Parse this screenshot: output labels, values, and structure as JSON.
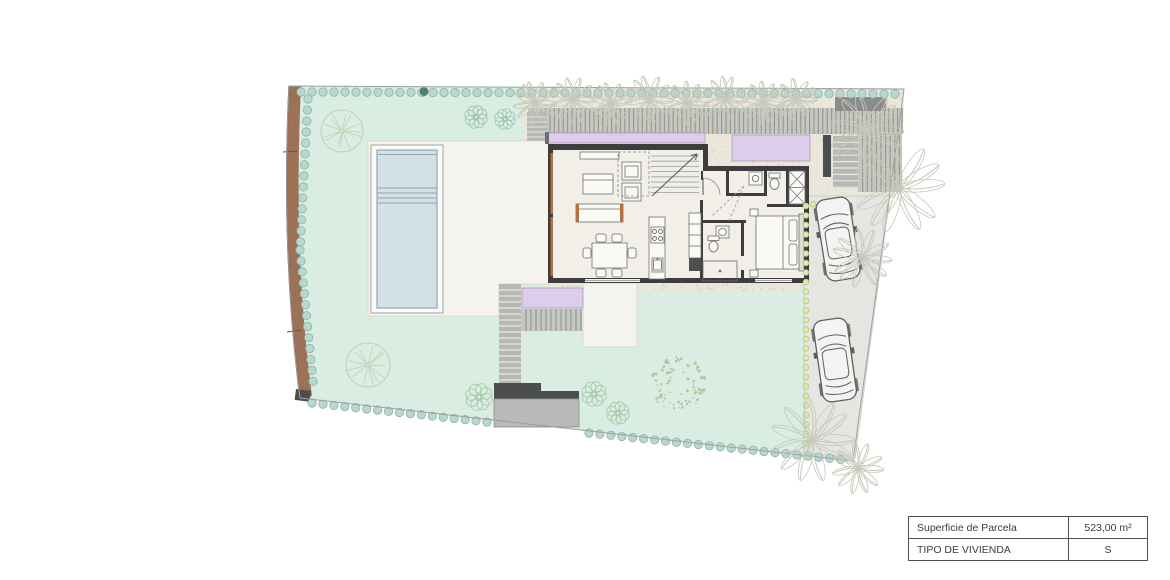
{
  "info_table": {
    "rows": [
      {
        "label": "Superficie de Parcela",
        "value": "523,00 m²"
      },
      {
        "label": "TIPO DE VIVIENDA",
        "value": "S"
      }
    ]
  },
  "plan_features": {
    "type": "residential-villa-site-plan",
    "car_count": 2,
    "elements": [
      "lawn",
      "perimeter-hedge",
      "boundary-wall",
      "swimming-pool",
      "pool-terrace",
      "timber-deck",
      "pergola-planters",
      "house-ground-floor",
      "living-room",
      "dining-area",
      "kitchen-island",
      "staircase",
      "bathrooms",
      "laundry",
      "bedroom",
      "entry-path",
      "entry-steps",
      "driveway",
      "parked-cars",
      "palm-trees",
      "garden-trees",
      "shrubs"
    ]
  },
  "palette": {
    "lawn": "#daede2",
    "concrete": "#eae6da",
    "speckle": "#cdc5b0",
    "terrace": "#f5f3ed",
    "pool_deck": "#fbfaf7",
    "pool_water": "#d3e0e6",
    "pool_line": "#8fa9b6",
    "house_floor": "#f1efe8",
    "wall": "#3d3d3d",
    "wood_accent": "#b2713f",
    "lavender": "#decdea",
    "lavender_edge": "#a79ab8",
    "deck_slat": "#c6c7c0",
    "deck_gap": "#94958d",
    "steps_fill": "#b7b8b4",
    "steps_line": "#e9e8e3",
    "entry_dark": "#4b4d4f",
    "entry_pad": "#b7bab8",
    "driveway": "#e5e6e2",
    "brown_wall": "#9c7156",
    "brown_dark": "#6f4e3a",
    "hedge": "#b8d8cf",
    "hedge_edge": "#8db3a9",
    "hedge_dark": "#4e7e72",
    "green_dot": "#dfe9b0",
    "green_dot_edge": "#b5c67e",
    "tree": "#c3cfb2",
    "palm": "#c6c8ba",
    "bush_teal": "#9fc6b6",
    "bush_green": "#a8cbaa",
    "scatter": "#b4c6a0",
    "car_line": "#5e605f",
    "car_fill": "#f3f4f1",
    "table_border": "#4f4f4f",
    "text": "#3d3d3d",
    "furniture_line": "#6f6f6f",
    "furniture_fill": "#faf9f5",
    "boundary": "#9e9e9e"
  }
}
